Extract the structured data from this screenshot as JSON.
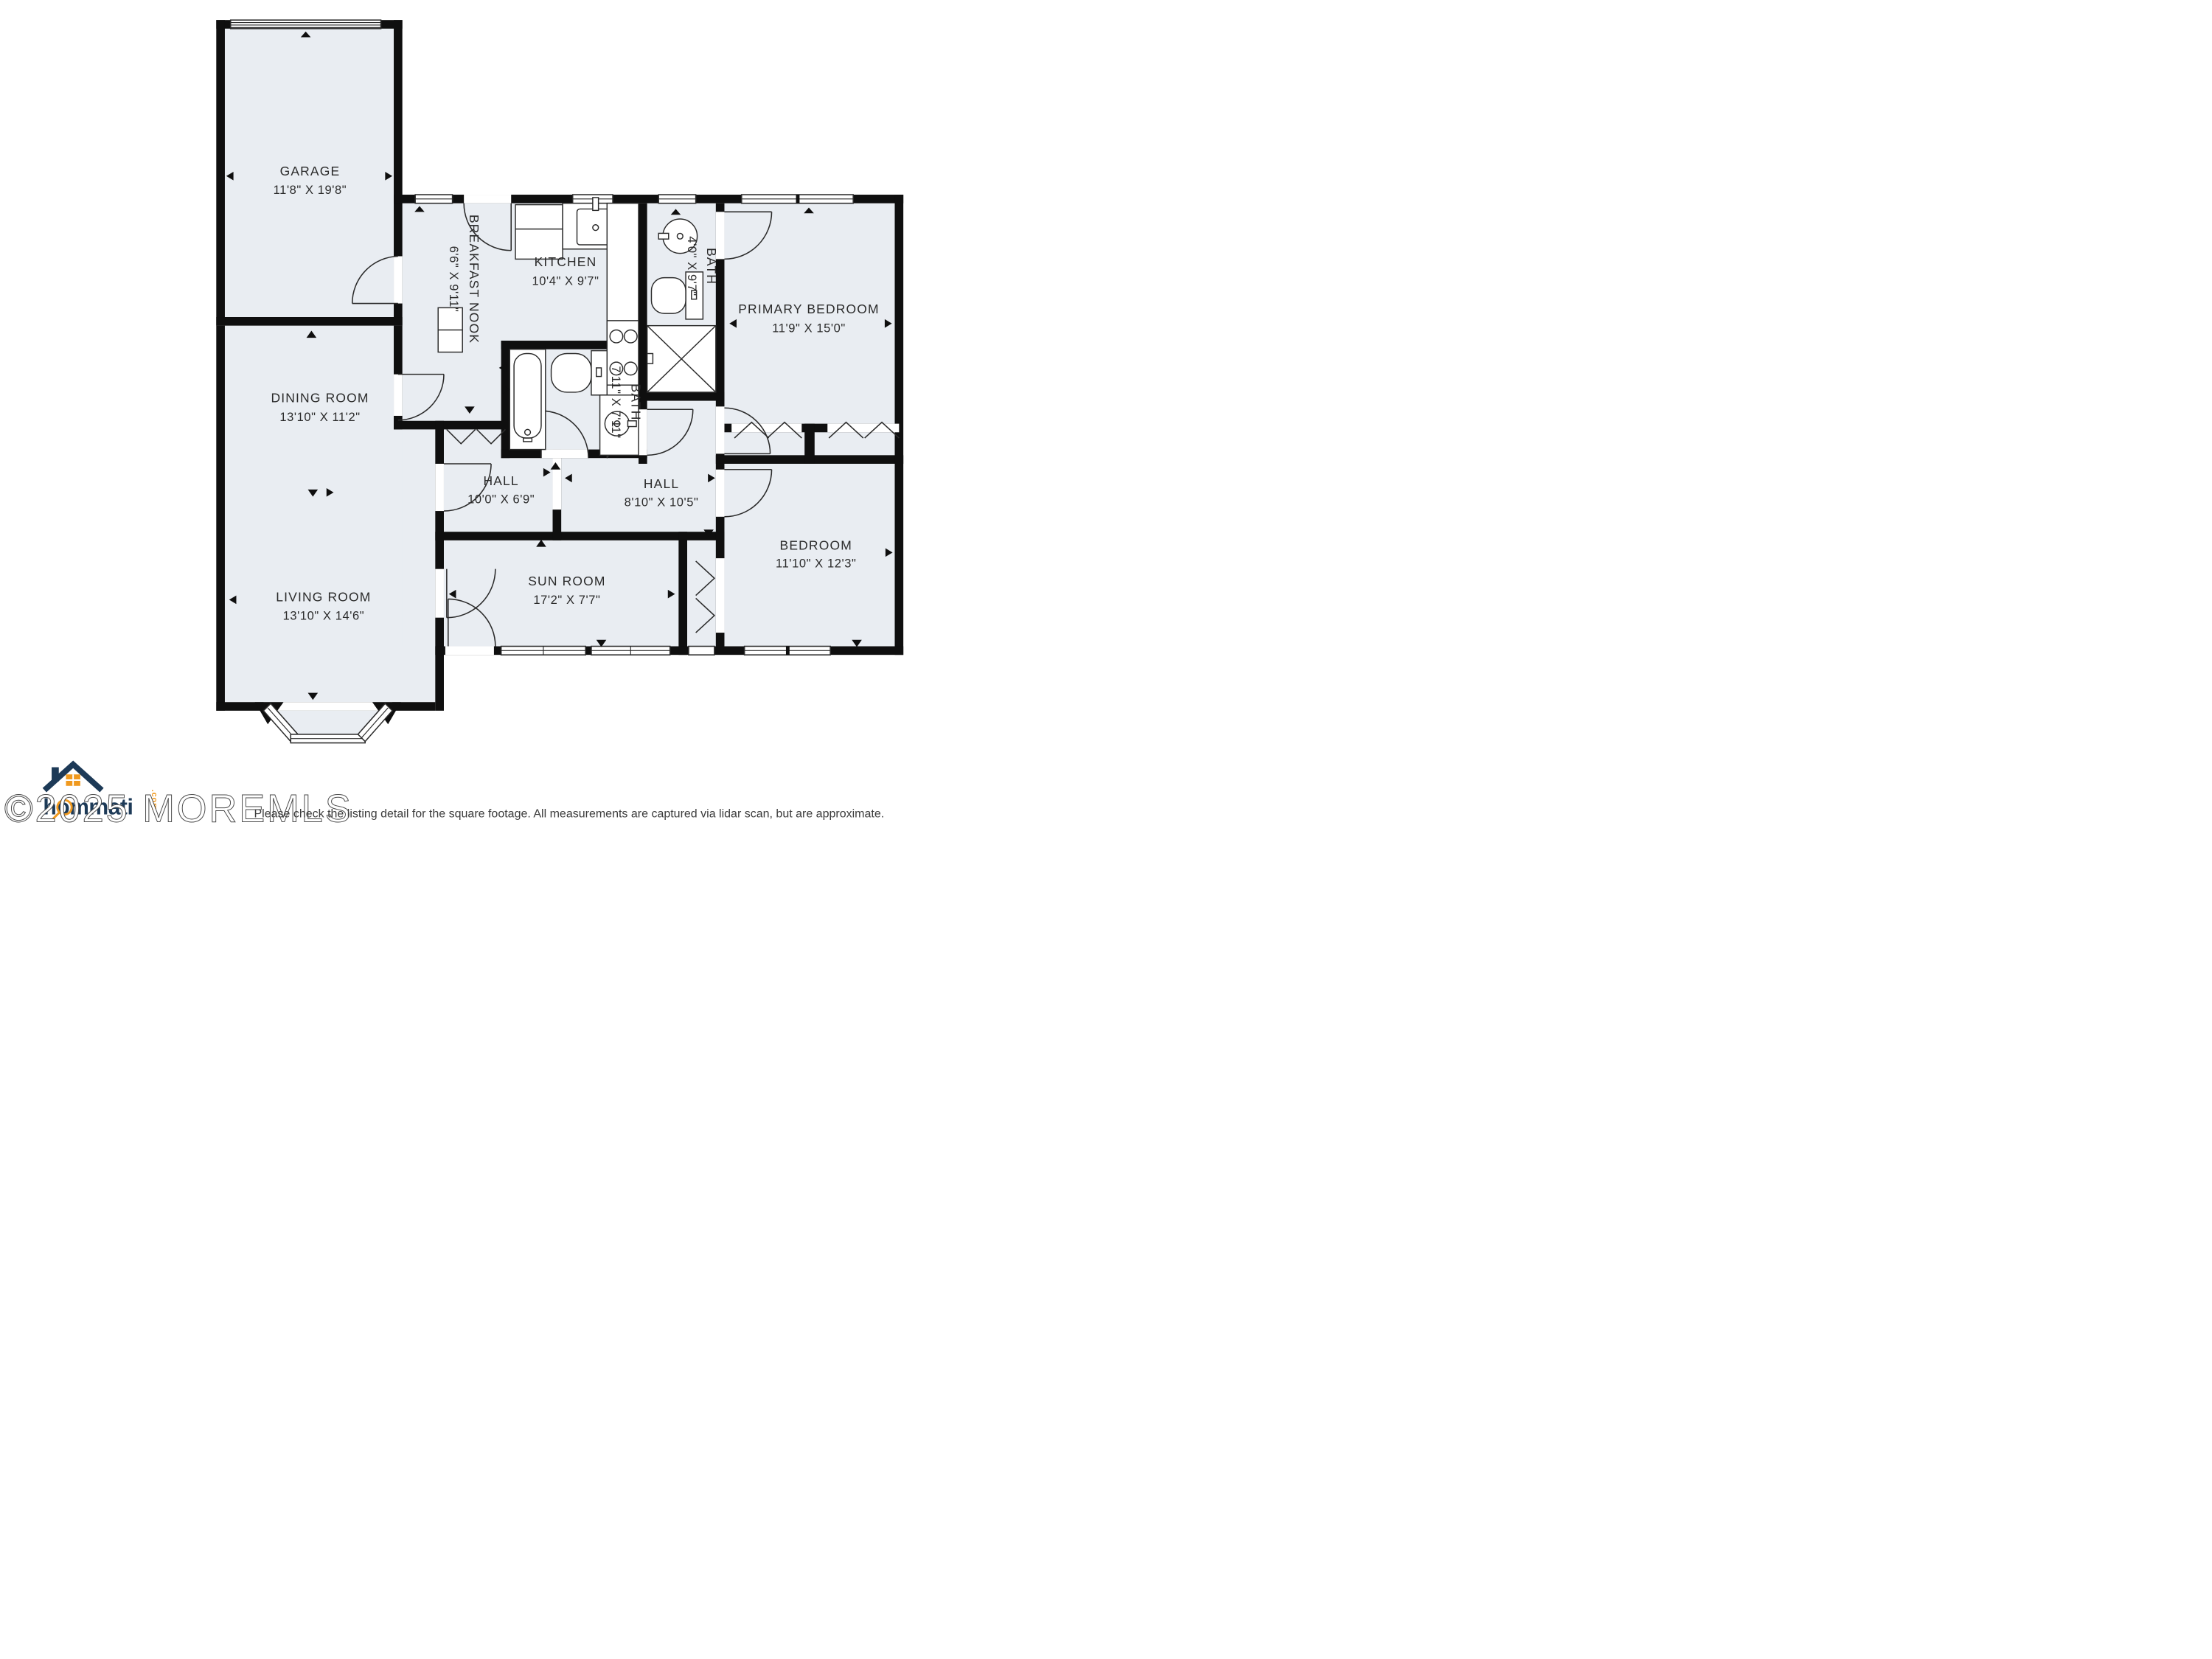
{
  "colors": {
    "floor": "#e9edf2",
    "wall": "#0f0f0f",
    "line": "#2b2b2b",
    "navy": "#1d3a57",
    "orange": "#f0991e"
  },
  "rooms": [
    {
      "id": "garage",
      "name": "GARAGE",
      "dims": "11'8\" X 19'8\""
    },
    {
      "id": "dining-room",
      "name": "DINING ROOM",
      "dims": "13'10\" X 11'2\""
    },
    {
      "id": "living-room",
      "name": "LIVING ROOM",
      "dims": "13'10\" X 14'6\""
    },
    {
      "id": "breakfast-nook",
      "name": "BREAKFAST NOOK",
      "dims": "6'6\" X 9'11\""
    },
    {
      "id": "kitchen",
      "name": "KITCHEN",
      "dims": "10'4\" X 9'7\""
    },
    {
      "id": "bath-ensuite",
      "name": "BATH",
      "dims": "4'0\" X 9'7\""
    },
    {
      "id": "primary-bedroom",
      "name": "PRIMARY BEDROOM",
      "dims": "11'9\" X 15'0\""
    },
    {
      "id": "bath",
      "name": "BATH",
      "dims": "7'11\" X 7'11\""
    },
    {
      "id": "hall-1",
      "name": "HALL",
      "dims": "10'0\" X 6'9\""
    },
    {
      "id": "hall-2",
      "name": "HALL",
      "dims": "8'10\" X 10'5\""
    },
    {
      "id": "sun-room",
      "name": "SUN ROOM",
      "dims": "17'2\" X 7'7\""
    },
    {
      "id": "bedroom",
      "name": "BEDROOM",
      "dims": "11'10\" X 12'3\""
    }
  ],
  "footer": {
    "watermark": "©2025 MOREMLS",
    "brand": "hommati",
    "brand_tld": ".com",
    "disclaimer": "Please check the listing detail for the square footage. All measurements are captured via lidar scan, but are approximate."
  }
}
